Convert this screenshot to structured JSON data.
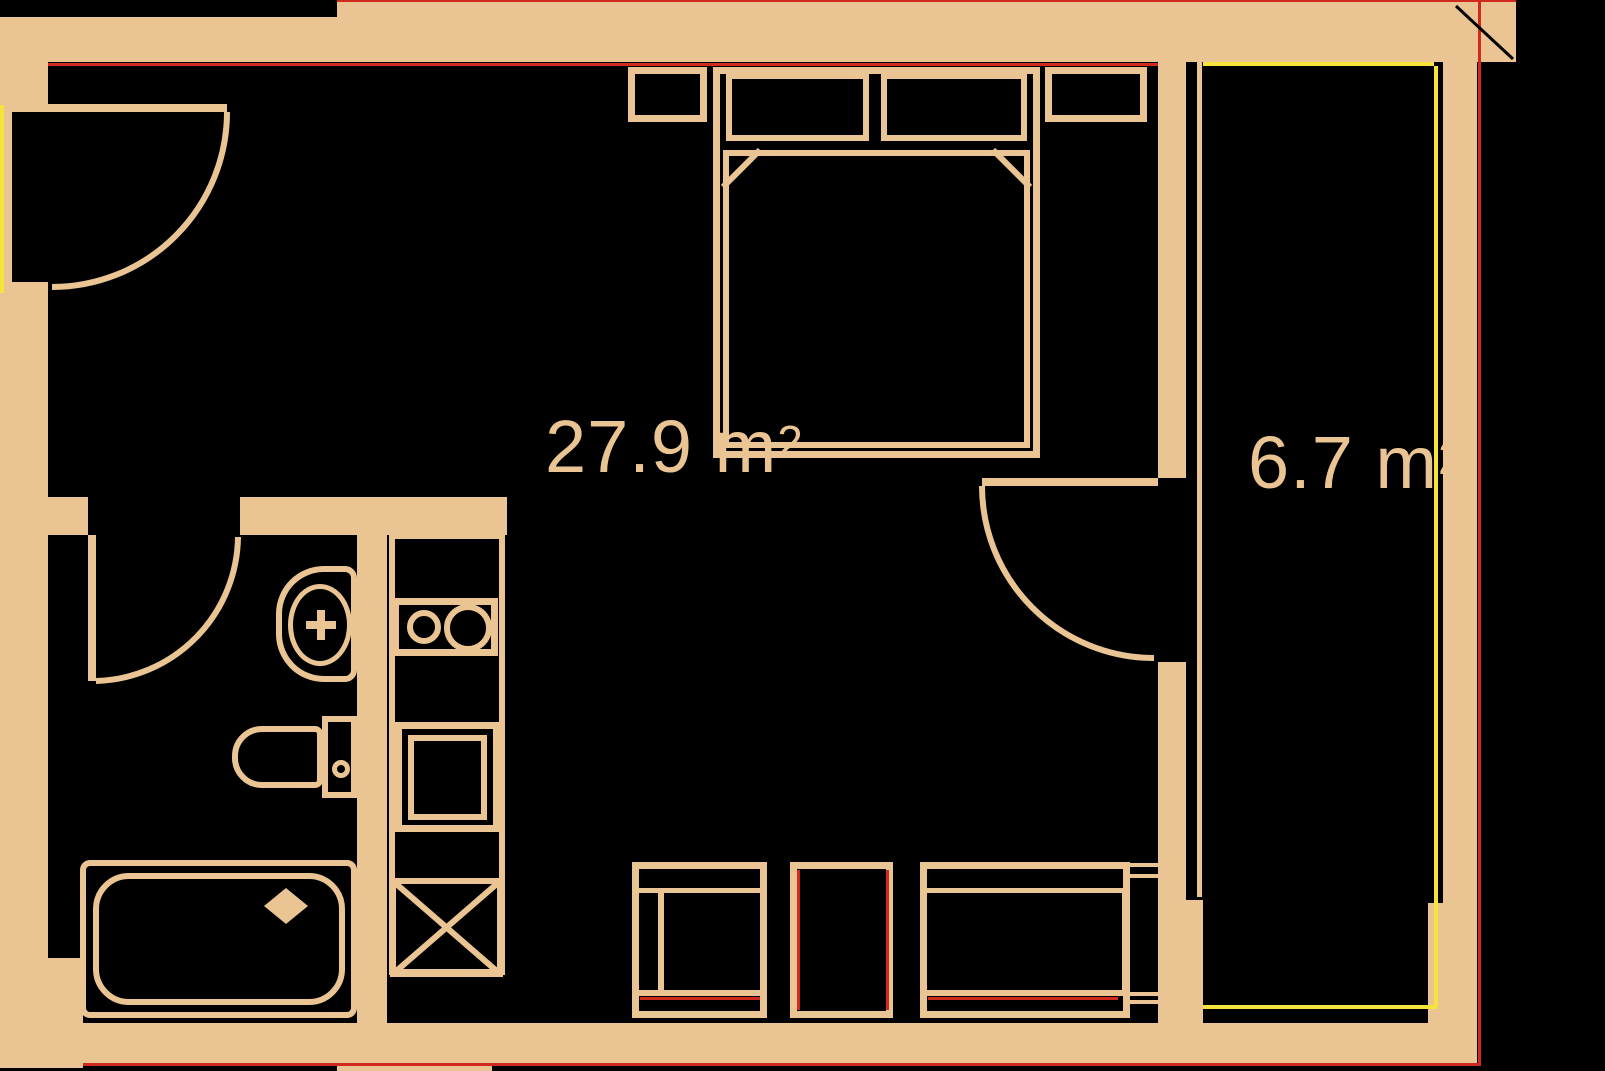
{
  "plan": {
    "colors": {
      "wall": "#eac593",
      "red": "#cf2a1d",
      "yellow": "#f4e43c",
      "bg": "#000000"
    },
    "rooms": [
      {
        "area_value": "27.9",
        "area_unit": " m",
        "area_sup": "2"
      },
      {
        "area_value": "6.7",
        "area_unit": " m",
        "area_sup": "2"
      }
    ],
    "fixtures": [
      "entrance-door",
      "interior-door",
      "balcony-door",
      "double-bed",
      "pillow",
      "nightstand",
      "bathroom-sink",
      "toilet",
      "bathtub",
      "kitchen-sink",
      "stove",
      "washing-machine",
      "bench-seat"
    ]
  }
}
